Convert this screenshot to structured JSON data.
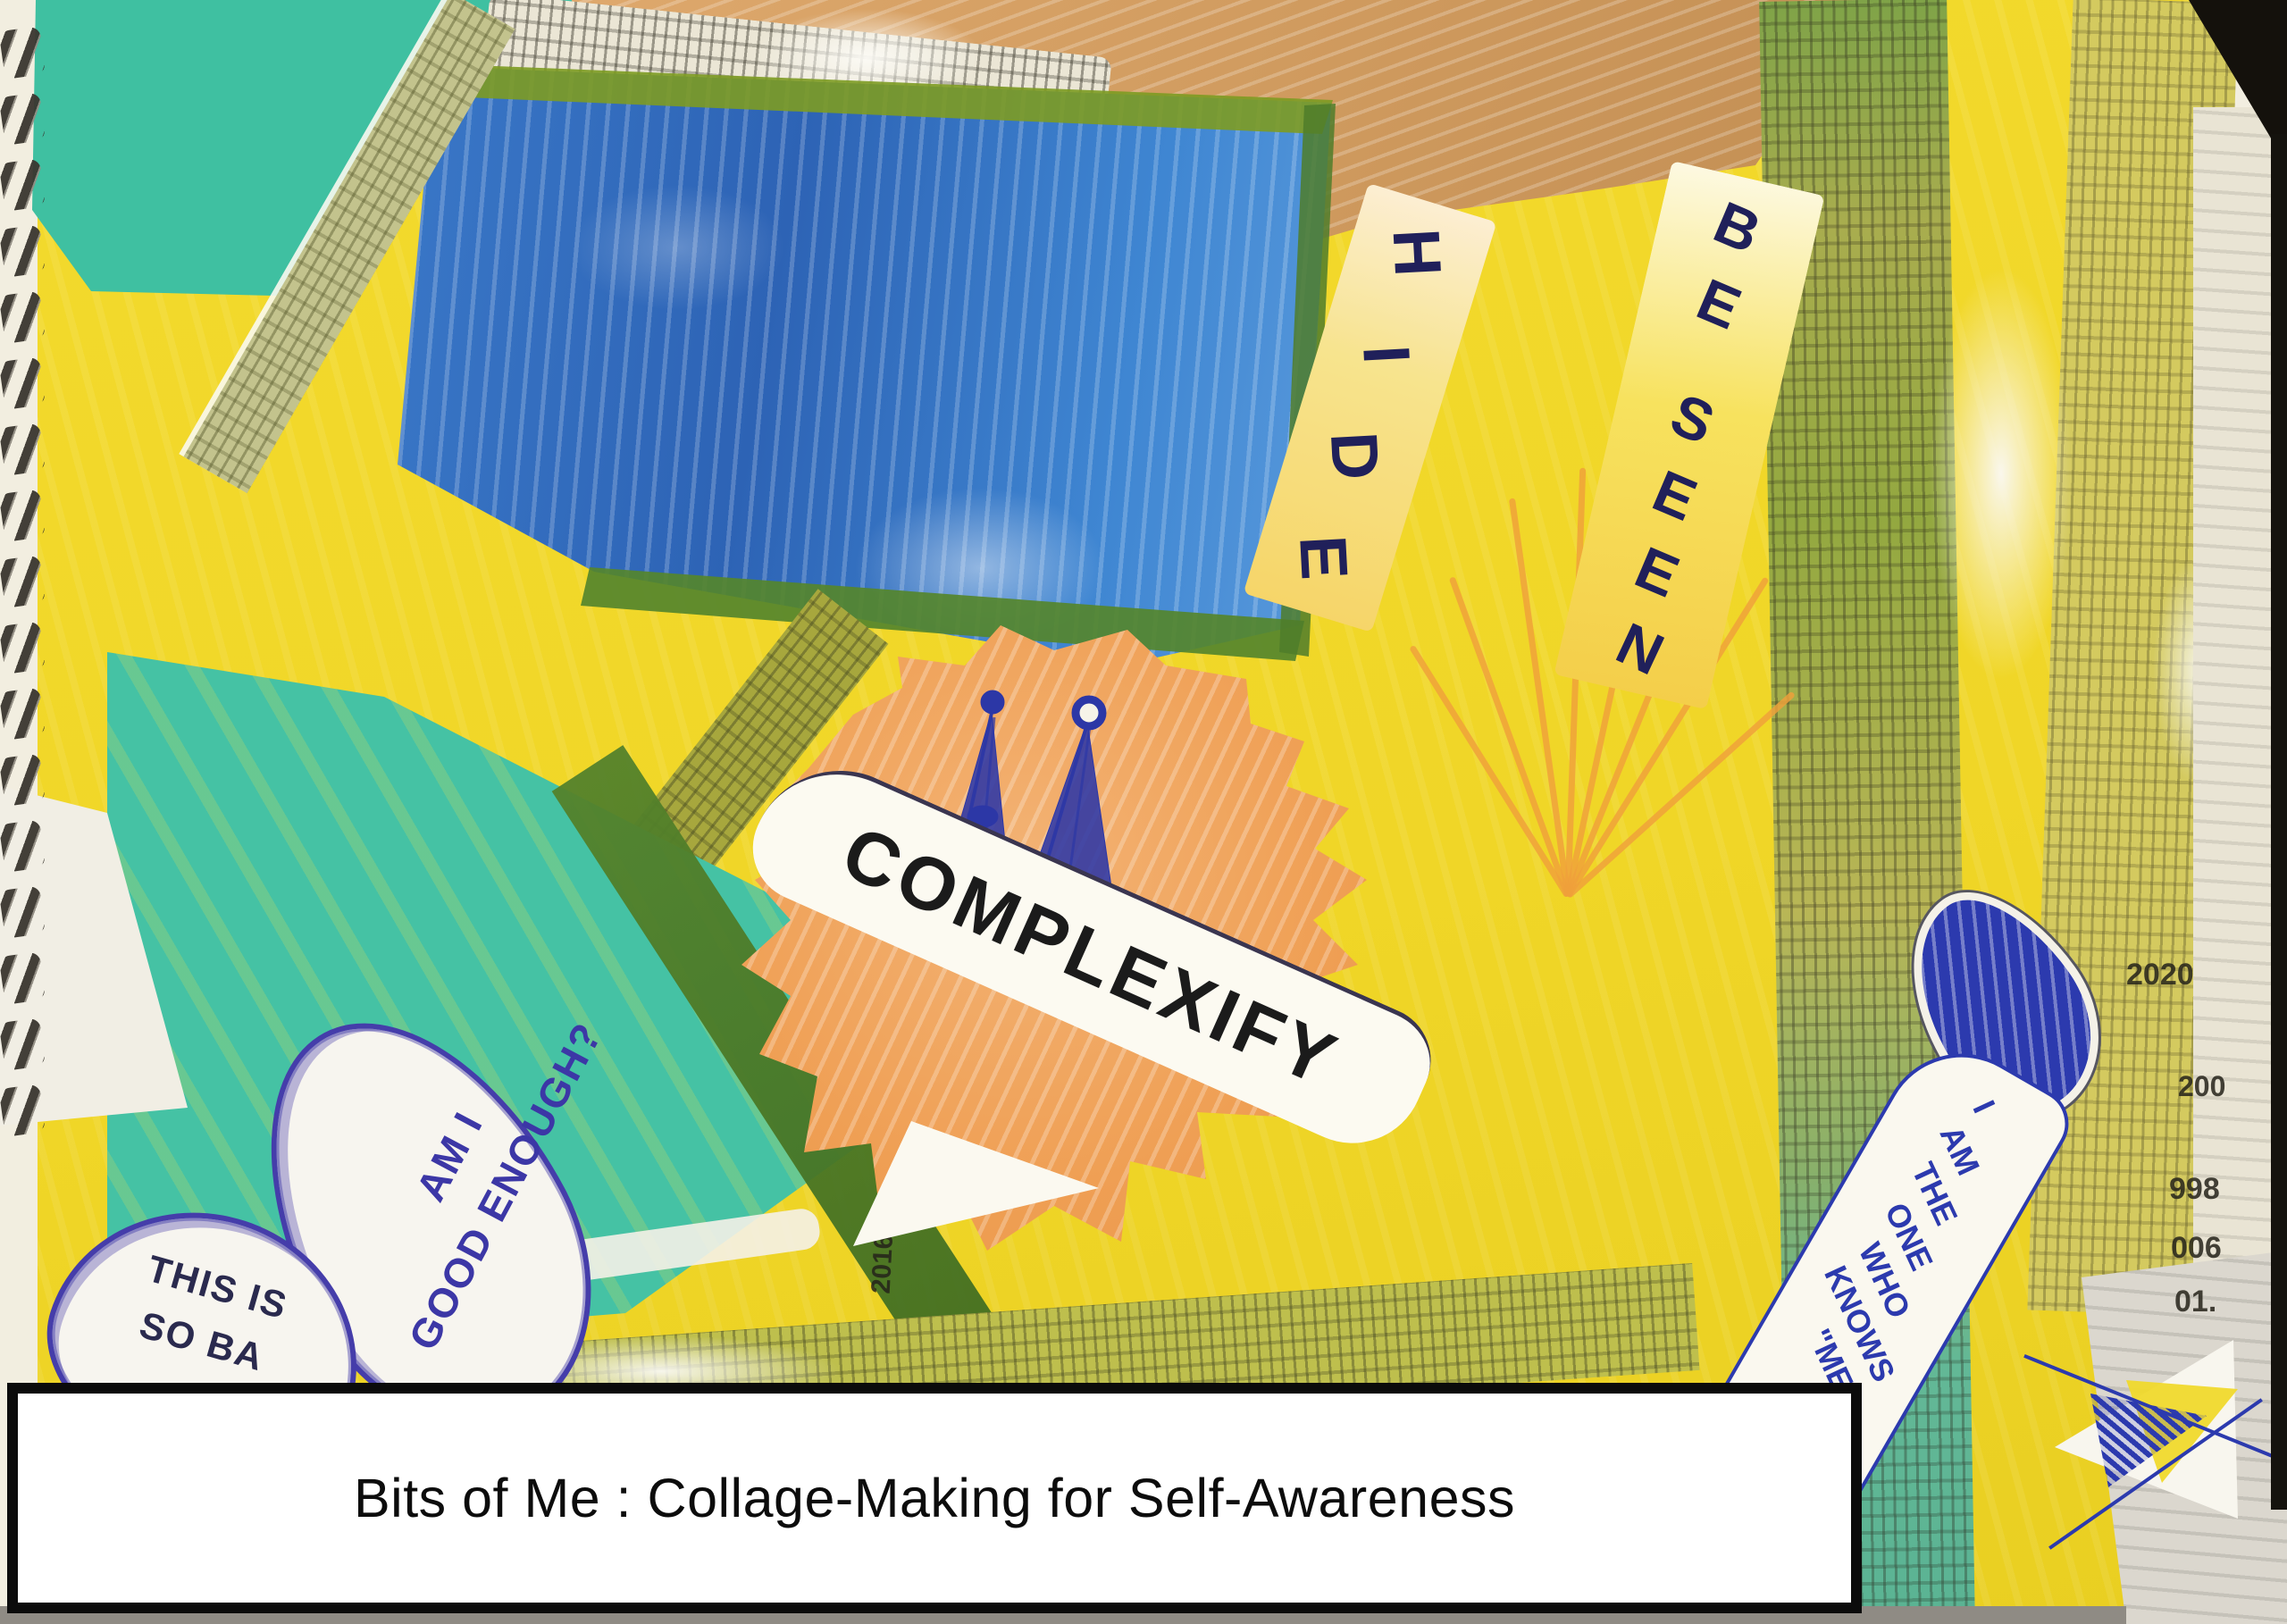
{
  "artwork": {
    "kind": "mixed-media collage photo on spiral sketchbook page",
    "caption": {
      "text": "Bits of Me : Collage-Making for Self-Awareness"
    },
    "texts": {
      "hide": {
        "label": "HIDE",
        "letters": [
          "H",
          "I",
          "D",
          "E"
        ]
      },
      "be_seen": {
        "label": "BE SEEN",
        "letters": [
          "B",
          "E",
          "S",
          "E",
          "E",
          "N"
        ]
      },
      "complexify": {
        "label": "COMPLEXIFY"
      },
      "bubble_am_i": {
        "line1": "AM I",
        "line2": "GOOD ENOUGH?"
      },
      "bubble_this_is": {
        "line1": "THIS IS",
        "line2": "SO BA"
      },
      "ribbon_words": [
        "I",
        "AM",
        "THE",
        "ONE",
        "WHO",
        "KNOWS",
        "\"ME\""
      ]
    },
    "newspaper_fragments": {
      "f1": "2016",
      "f2": "2020",
      "f3": "200",
      "f4": "998",
      "f5": "006",
      "f6": "01."
    },
    "colors": {
      "teal": "#43c2a4",
      "yellow": "#f1d82b",
      "blue_patch": "#2f6dbf",
      "tan": "#d09b60",
      "orange_burst": "#f0a159",
      "ink_blue": "#2c3aae",
      "olive": "#9aa638",
      "dark_green": "#4f7e28"
    }
  }
}
